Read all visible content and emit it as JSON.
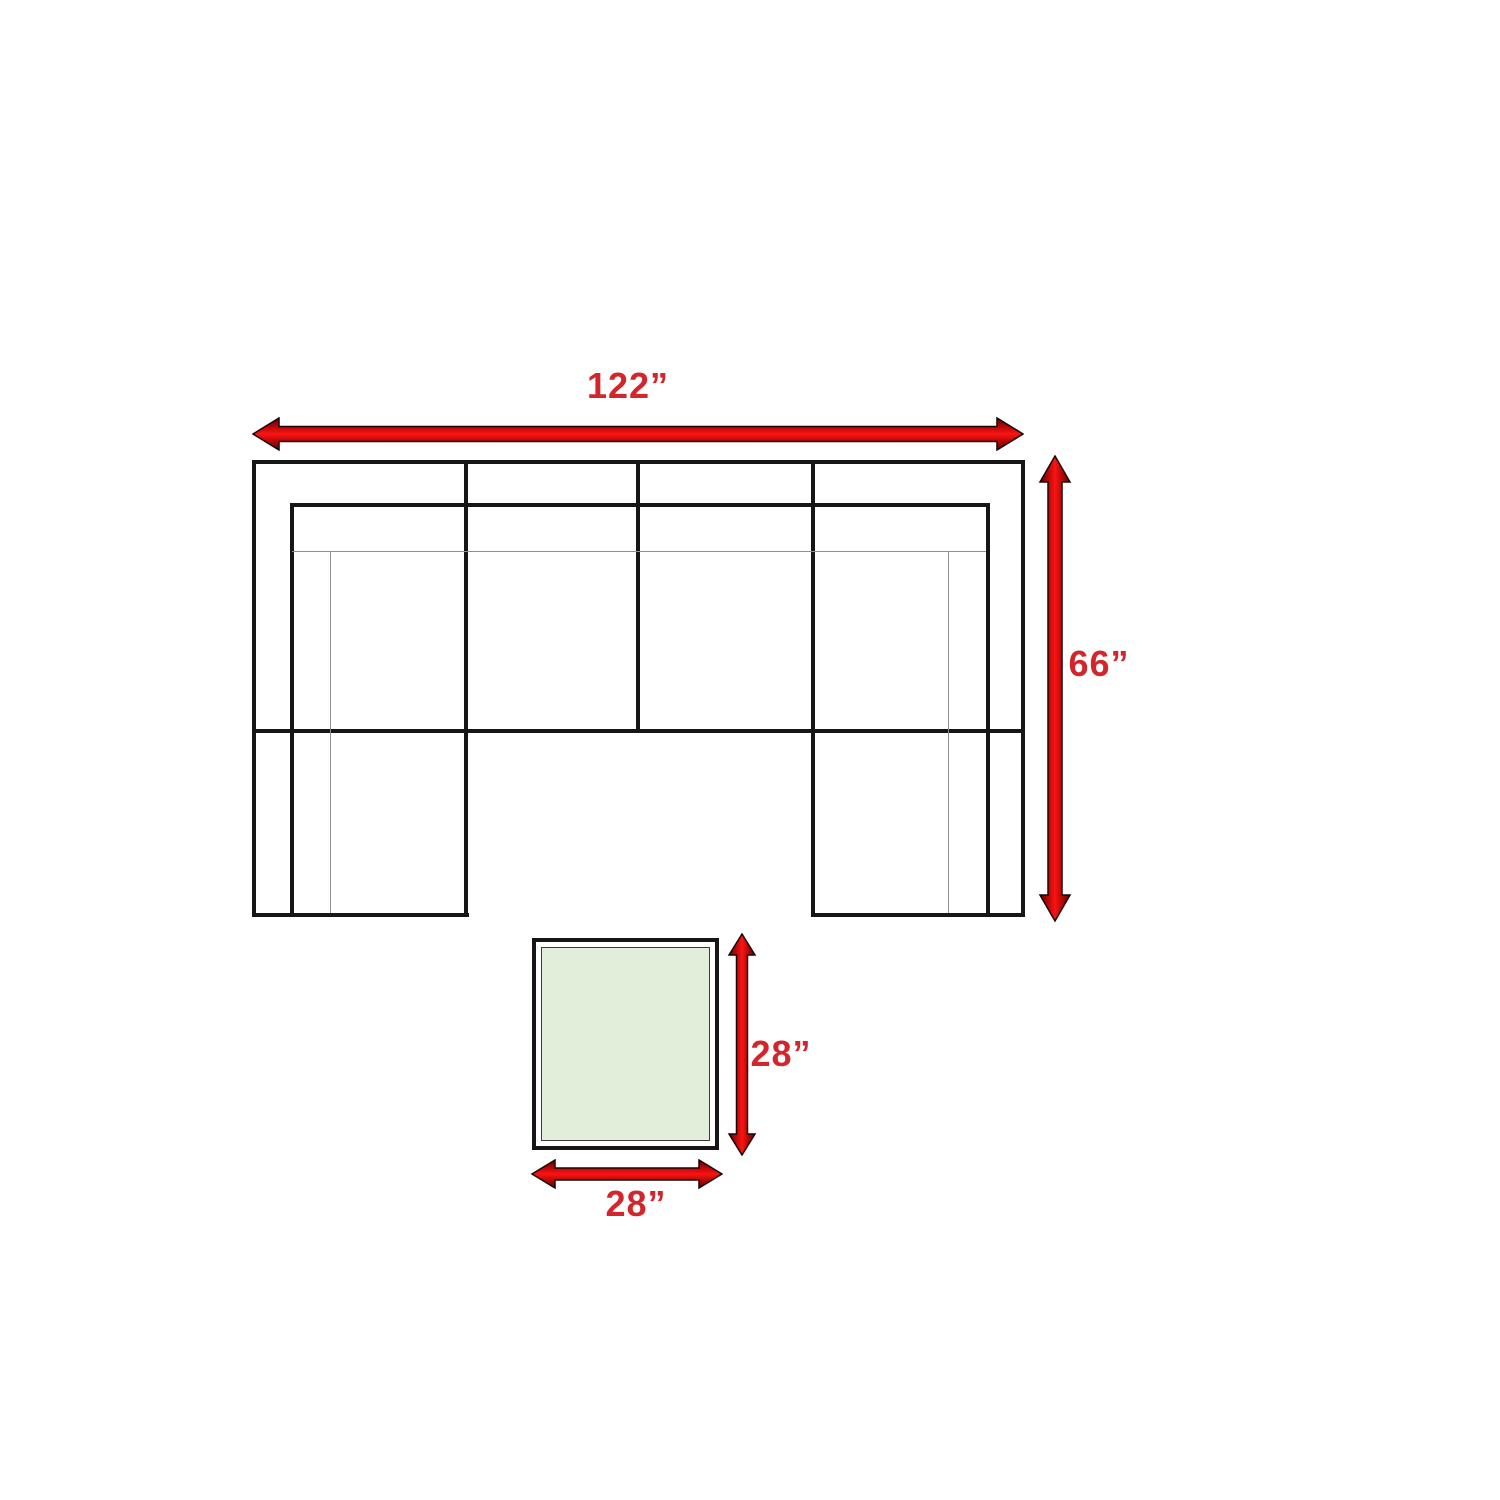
{
  "diagram": {
    "sofa": {
      "width_label": "122”",
      "depth_label": "66”"
    },
    "ottoman": {
      "depth_label": "28”",
      "width_label": "28”"
    },
    "colors": {
      "label_red": "#d2262c",
      "arrow_red": "#e01010",
      "line_black": "#161616",
      "ottoman_fill": "#e0eeda"
    }
  }
}
